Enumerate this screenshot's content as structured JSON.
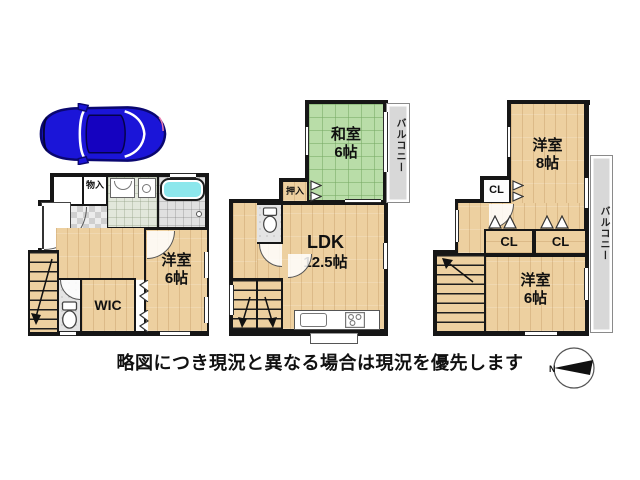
{
  "note": "略図につき現況と異なる場合は現況を優先します",
  "compass": {
    "north_label": "N"
  },
  "floor1": {
    "storage_label": "物入",
    "wic_label": "WIC",
    "bedroom_name": "洋室",
    "bedroom_size": "6帖"
  },
  "floor2": {
    "tatami_name": "和室",
    "tatami_size": "6帖",
    "balcony_label": "バルコニー",
    "closet_label": "押入",
    "ldk_name": "LDK",
    "ldk_size": "12.5帖"
  },
  "floor3": {
    "bedroom8_name": "洋室",
    "bedroom8_size": "8帖",
    "closet_top_label": "CL",
    "closet_a_label": "CL",
    "closet_b_label": "CL",
    "balcony_label": "バルコニー",
    "bedroom6_name": "洋室",
    "bedroom6_size": "6帖"
  },
  "colors": {
    "wall": "#161616",
    "wood": "#edd0a0",
    "tatami": "#b9dda8",
    "balcony": "#d8d8d8",
    "bathtub": "#8ce7ec",
    "car": "#1b15d8"
  }
}
